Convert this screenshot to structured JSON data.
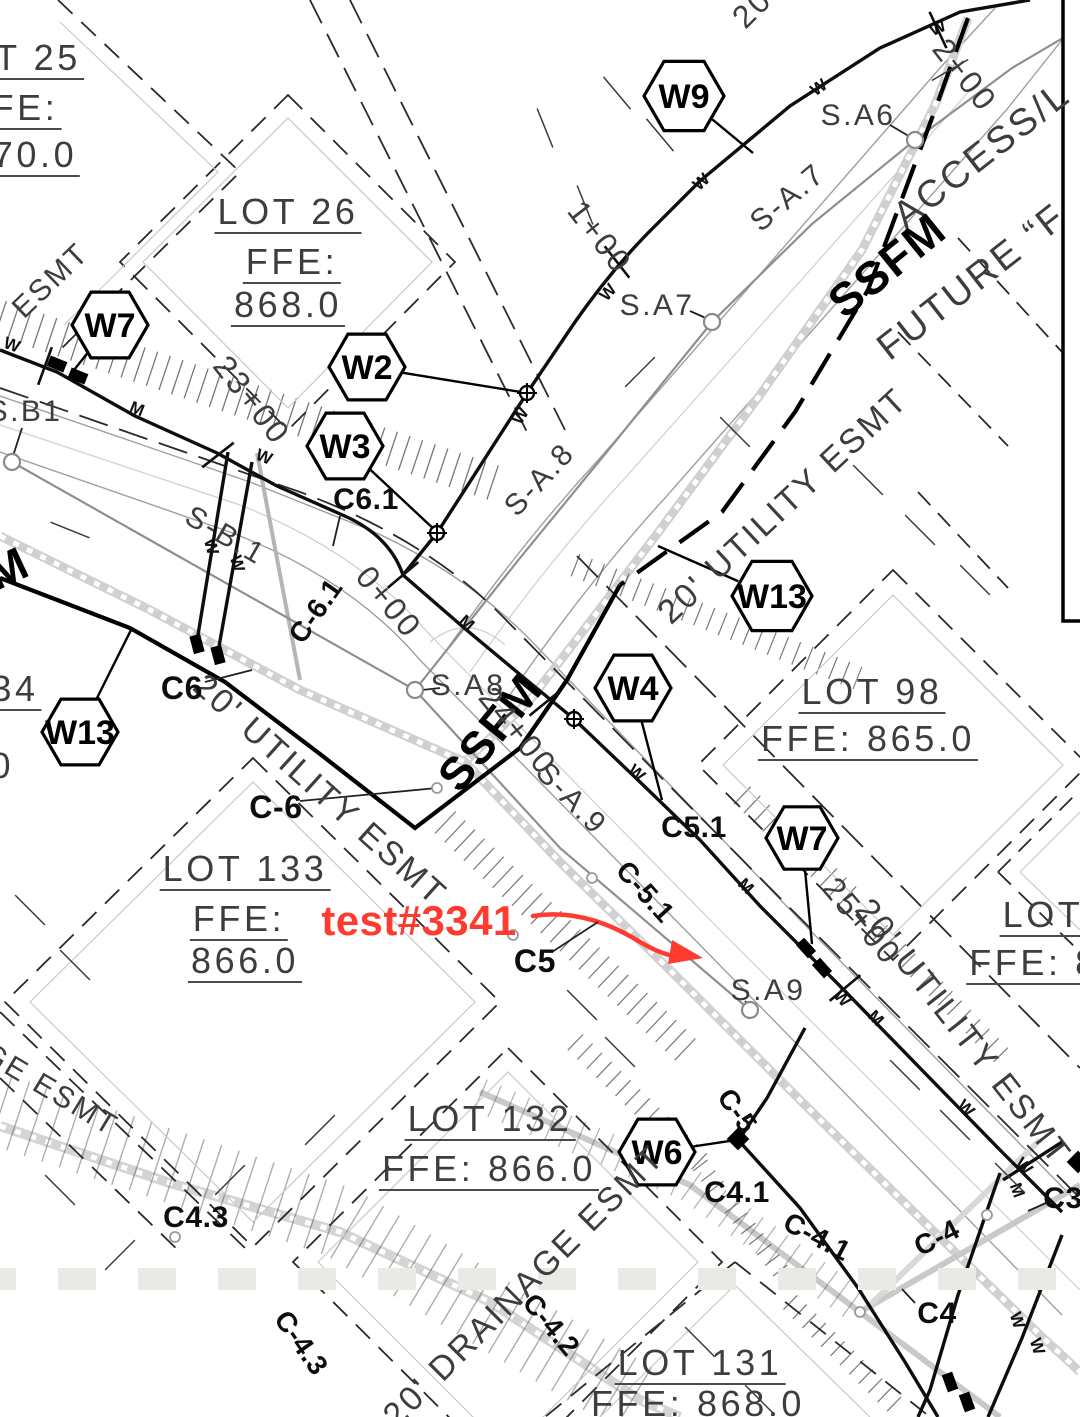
{
  "annotation": {
    "text": "test#3341",
    "color": "#ff3b30"
  },
  "colors": {
    "line_black": "#111111",
    "cad_text": "#3d3d3d",
    "road_gray": "#9f9f9f",
    "band_gray": "#d0d0d0",
    "grass_square": "#e7eae5",
    "annotation_red": "#ff3b30"
  },
  "label_groups": {
    "lots": [
      {
        "name": "lot25-number",
        "text": "T 25",
        "x": 38,
        "y": 60,
        "rot": 0,
        "fs": 36,
        "cls": "cadu"
      },
      {
        "name": "lot25-ffe",
        "text": "FE:",
        "x": 25,
        "y": 110,
        "rot": 0,
        "fs": 36,
        "cls": "cadu"
      },
      {
        "name": "lot25-ffe-value",
        "text": "70.0",
        "x": 35,
        "y": 157,
        "rot": 0,
        "fs": 36,
        "cls": "cadu"
      },
      {
        "name": "lot26-number",
        "text": "LOT 26",
        "x": 288,
        "y": 214,
        "rot": 0,
        "fs": 36,
        "cls": "cadu"
      },
      {
        "name": "lot26-ffe",
        "text": "FFE:",
        "x": 292,
        "y": 264,
        "rot": 0,
        "fs": 36,
        "cls": "cadu"
      },
      {
        "name": "lot26-ffe-value",
        "text": "868.0",
        "x": 288,
        "y": 307,
        "rot": 0,
        "fs": 36,
        "cls": "cadu"
      },
      {
        "name": "lot98-number",
        "text": "LOT 98",
        "x": 872,
        "y": 694,
        "rot": 0,
        "fs": 36,
        "cls": "cadu"
      },
      {
        "name": "lot98-ffe",
        "text": "FFE: 865.0",
        "x": 868,
        "y": 741,
        "rot": 0,
        "fs": 36,
        "cls": "cadu"
      },
      {
        "name": "lot133-number",
        "text": "LOT 133",
        "x": 245,
        "y": 871,
        "rot": 0,
        "fs": 36,
        "cls": "cadu"
      },
      {
        "name": "lot133-ffe",
        "text": "FFE:",
        "x": 239,
        "y": 921,
        "rot": 0,
        "fs": 36,
        "cls": "cadu"
      },
      {
        "name": "lot133-ffe-value",
        "text": "866.0",
        "x": 245,
        "y": 963,
        "rot": 0,
        "fs": 36,
        "cls": "cadu"
      },
      {
        "name": "lot132-number",
        "text": "LOT 132",
        "x": 490,
        "y": 1121,
        "rot": 0,
        "fs": 36,
        "cls": "cadu"
      },
      {
        "name": "lot132-ffe",
        "text": "FFE: 866.0",
        "x": 489,
        "y": 1171,
        "rot": 0,
        "fs": 36,
        "cls": "cadu"
      },
      {
        "name": "lot131-number",
        "text": "LOT 131",
        "x": 700,
        "y": 1365,
        "rot": 0,
        "fs": 36,
        "cls": "cadu"
      },
      {
        "name": "lot131-ffe",
        "text": "FFE: 868.0",
        "x": 698,
        "y": 1406,
        "rot": 0,
        "fs": 36,
        "cls": "cadu"
      },
      {
        "name": "lot-right-number",
        "text": "LOT",
        "x": 1043,
        "y": 917,
        "rot": 0,
        "fs": 36,
        "cls": "cadu"
      },
      {
        "name": "lot-right-ffe",
        "text": "FFE: 8",
        "x": 1034,
        "y": 965,
        "rot": 0,
        "fs": 36,
        "cls": "cadu"
      }
    ],
    "easements": [
      {
        "name": "esmt-top-left",
        "text": "ESMT",
        "x": 51,
        "y": 281,
        "rot": -44,
        "fs": 30,
        "cls": "cad"
      },
      {
        "name": "utility-esmt-top-right",
        "text": "20' UTILITY ESMT",
        "x": 783,
        "y": 506,
        "rot": -43,
        "fs": 34,
        "cls": "cad"
      },
      {
        "name": "utility-esmt-left",
        "text": "20' UTILITY ESMT",
        "x": 320,
        "y": 790,
        "rot": 42,
        "fs": 34,
        "cls": "cad"
      },
      {
        "name": "utility-esmt-right",
        "text": "20' UTILITY ESMT",
        "x": 963,
        "y": 1032,
        "rot": 52,
        "fs": 34,
        "cls": "cad"
      },
      {
        "name": "drainage-esmt",
        "text": "20' DRAINAGE ESMT",
        "x": 524,
        "y": 1286,
        "rot": -45,
        "fs": 34,
        "cls": "cad"
      },
      {
        "name": "drainage-esmt-frag",
        "text": "GE ESMT",
        "x": 50,
        "y": 1090,
        "rot": 31,
        "fs": 30,
        "cls": "cad"
      },
      {
        "name": "esmt-top-frag",
        "text": "20",
        "x": 752,
        "y": 8,
        "rot": -45,
        "fs": 32,
        "cls": "cad"
      },
      {
        "name": "access-road",
        "text": "ACCESS/L",
        "x": 982,
        "y": 155,
        "rot": -38,
        "fs": 38,
        "cls": "cad"
      },
      {
        "name": "future-road",
        "text": "FUTURE “F",
        "x": 972,
        "y": 282,
        "rot": -38,
        "fs": 38,
        "cls": "cad"
      }
    ],
    "force_main": [
      {
        "name": "ssfm-top",
        "text": "SSFM",
        "x": 887,
        "y": 265,
        "rot": -39,
        "fs": 46,
        "cls": "ssfm"
      },
      {
        "name": "ssfm-center",
        "text": "SSFM",
        "x": 490,
        "y": 732,
        "rot": -51,
        "fs": 46,
        "cls": "ssfm"
      },
      {
        "name": "ssfm-left",
        "text": "SSFM",
        "x": -35,
        "y": 588,
        "rot": -25,
        "fs": 46,
        "cls": "ssfm"
      }
    ],
    "sewer": [
      {
        "name": "manhole-sa6",
        "text": "S.A6",
        "x": 858,
        "y": 116,
        "rot": 0,
        "fs": 30,
        "cls": "cad"
      },
      {
        "name": "manhole-sa7",
        "text": "S.A7",
        "x": 657,
        "y": 306,
        "rot": 0,
        "fs": 30,
        "cls": "cad"
      },
      {
        "name": "manhole-sa8",
        "text": "S.A8",
        "x": 468,
        "y": 686,
        "rot": 0,
        "fs": 30,
        "cls": "cad"
      },
      {
        "name": "manhole-sa9",
        "text": "S.A9",
        "x": 768,
        "y": 991,
        "rot": 0,
        "fs": 30,
        "cls": "cad"
      },
      {
        "name": "manhole-sb1",
        "text": "S.B1",
        "x": 25,
        "y": 412,
        "rot": 0,
        "fs": 30,
        "cls": "cad"
      },
      {
        "name": "sewer-run-sa7",
        "text": "S-A.7",
        "x": 788,
        "y": 198,
        "rot": -40,
        "fs": 30,
        "cls": "cad"
      },
      {
        "name": "sewer-run-sa8",
        "text": "S-A.8",
        "x": 540,
        "y": 480,
        "rot": -47,
        "fs": 30,
        "cls": "cad"
      },
      {
        "name": "sewer-run-sa9",
        "text": "S-A.9",
        "x": 571,
        "y": 799,
        "rot": 46,
        "fs": 30,
        "cls": "cad"
      },
      {
        "name": "sewer-run-sb1",
        "text": "S-B.1",
        "x": 225,
        "y": 536,
        "rot": 30,
        "fs": 30,
        "cls": "cad"
      }
    ],
    "stations": [
      {
        "name": "station-2-00",
        "text": "2+00",
        "x": 965,
        "y": 75,
        "rot": 52,
        "fs": 32,
        "cls": "cad"
      },
      {
        "name": "station-1-00",
        "text": "1+00",
        "x": 600,
        "y": 237,
        "rot": 52,
        "fs": 32,
        "cls": "cad"
      },
      {
        "name": "station-0-00",
        "text": "0+00",
        "x": 389,
        "y": 602,
        "rot": 50,
        "fs": 32,
        "cls": "cad"
      },
      {
        "name": "station-23-00",
        "text": "23+00",
        "x": 252,
        "y": 400,
        "rot": 52,
        "fs": 32,
        "cls": "cad"
      },
      {
        "name": "station-24-00",
        "text": "24+00",
        "x": 518,
        "y": 731,
        "rot": 51,
        "fs": 32,
        "cls": "cad"
      },
      {
        "name": "station-25-00",
        "text": "25+00",
        "x": 862,
        "y": 921,
        "rot": 50,
        "fs": 32,
        "cls": "cad"
      }
    ],
    "curve_callouts": [
      {
        "name": "callout-c6-1",
        "text": "C6.1",
        "x": 366,
        "y": 500,
        "rot": 0,
        "fs": 30,
        "cls": "c"
      },
      {
        "name": "callout-c-6-1",
        "text": "C-6.1",
        "x": 316,
        "y": 611,
        "rot": -55,
        "fs": 28,
        "cls": "c"
      },
      {
        "name": "callout-c6",
        "text": "C6",
        "x": 182,
        "y": 688,
        "rot": 0,
        "fs": 32,
        "cls": "c"
      },
      {
        "name": "callout-c-6",
        "text": "C-6",
        "x": 276,
        "y": 807,
        "rot": 0,
        "fs": 32,
        "cls": "c"
      },
      {
        "name": "callout-c5-1",
        "text": "C5.1",
        "x": 694,
        "y": 828,
        "rot": 0,
        "fs": 30,
        "cls": "c"
      },
      {
        "name": "callout-c-5-1",
        "text": "C-5.1",
        "x": 645,
        "y": 892,
        "rot": 48,
        "fs": 28,
        "cls": "c"
      },
      {
        "name": "callout-c5",
        "text": "C5",
        "x": 535,
        "y": 961,
        "rot": 0,
        "fs": 32,
        "cls": "c"
      },
      {
        "name": "callout-c-5",
        "text": "C-5",
        "x": 737,
        "y": 1111,
        "rot": 55,
        "fs": 28,
        "cls": "c"
      },
      {
        "name": "callout-c4-1",
        "text": "C4.1",
        "x": 737,
        "y": 1193,
        "rot": 0,
        "fs": 30,
        "cls": "c"
      },
      {
        "name": "callout-c-4-1",
        "text": "C-4.1",
        "x": 817,
        "y": 1237,
        "rot": 28,
        "fs": 28,
        "cls": "c"
      },
      {
        "name": "callout-c4",
        "text": "C4",
        "x": 937,
        "y": 1314,
        "rot": 0,
        "fs": 30,
        "cls": "c"
      },
      {
        "name": "callout-c-4",
        "text": "C-4",
        "x": 937,
        "y": 1238,
        "rot": -27,
        "fs": 28,
        "cls": "c"
      },
      {
        "name": "callout-c4-3",
        "text": "C4.3",
        "x": 196,
        "y": 1218,
        "rot": 0,
        "fs": 30,
        "cls": "c"
      },
      {
        "name": "callout-c-4-3",
        "text": "C-4.3",
        "x": 301,
        "y": 1343,
        "rot": 55,
        "fs": 28,
        "cls": "c"
      },
      {
        "name": "callout-c-4-2",
        "text": "C-4.2",
        "x": 551,
        "y": 1325,
        "rot": 50,
        "fs": 28,
        "cls": "c"
      },
      {
        "name": "callout-c3",
        "text": "C3",
        "x": 1063,
        "y": 1199,
        "rot": 0,
        "fs": 30,
        "cls": "c"
      }
    ],
    "fragments": [
      {
        "name": "fragment-34",
        "text": "34",
        "x": 15,
        "y": 691,
        "rot": 0,
        "fs": 36,
        "cls": "cadu"
      },
      {
        "name": "fragment-0",
        "text": "0",
        "x": 2,
        "y": 766,
        "rot": 0,
        "fs": 36,
        "cls": "cad"
      }
    ]
  },
  "hex_flags": [
    {
      "name": "flag-w9",
      "label": "W9",
      "cx": 684,
      "cy": 96,
      "r": 40,
      "lx": 753,
      "ly": 153
    },
    {
      "name": "flag-w7-left",
      "label": "W7",
      "cx": 110,
      "cy": 325,
      "r": 38,
      "lx": 74,
      "ly": 370
    },
    {
      "name": "flag-w2",
      "label": "W2",
      "cx": 367,
      "cy": 367,
      "r": 38,
      "lx": 527,
      "ly": 393
    },
    {
      "name": "flag-w3",
      "label": "W3",
      "cx": 345,
      "cy": 446,
      "r": 38,
      "lx": 437,
      "ly": 532
    },
    {
      "name": "flag-w13-right",
      "label": "W13",
      "cx": 772,
      "cy": 596,
      "r": 40,
      "lx": 658,
      "ly": 546
    },
    {
      "name": "flag-w4",
      "label": "W4",
      "cx": 633,
      "cy": 688,
      "r": 38,
      "lx": 662,
      "ly": 800
    },
    {
      "name": "flag-w13-left",
      "label": "W13",
      "cx": 80,
      "cy": 732,
      "r": 38,
      "lx": 131,
      "ly": 630
    },
    {
      "name": "flag-w7-right",
      "label": "W7",
      "cx": 802,
      "cy": 838,
      "r": 36,
      "lx": 812,
      "ly": 944
    },
    {
      "name": "flag-w6",
      "label": "W6",
      "cx": 657,
      "cy": 1152,
      "r": 38,
      "lx": 736,
      "ly": 1140
    }
  ],
  "pipe_markers": [
    {
      "ch": "W",
      "x": 10,
      "y": 350,
      "rot": 20
    },
    {
      "ch": "M",
      "x": 135,
      "y": 414,
      "rot": 22
    },
    {
      "ch": "W",
      "x": 262,
      "y": 462,
      "rot": 22
    },
    {
      "ch": "W",
      "x": 206,
      "y": 548,
      "rot": 75
    },
    {
      "ch": "W",
      "x": 232,
      "y": 565,
      "rot": 75
    },
    {
      "ch": "W",
      "x": 525,
      "y": 419,
      "rot": -57
    },
    {
      "ch": "W",
      "x": 612,
      "y": 296,
      "rot": -48
    },
    {
      "ch": "W",
      "x": 705,
      "y": 186,
      "rot": -42
    },
    {
      "ch": "W",
      "x": 822,
      "y": 92,
      "rot": -35
    },
    {
      "ch": "W",
      "x": 940,
      "y": 33,
      "rot": -25
    },
    {
      "ch": "M",
      "x": 463,
      "y": 627,
      "rot": 42
    },
    {
      "ch": "W",
      "x": 633,
      "y": 777,
      "rot": 42
    },
    {
      "ch": "M",
      "x": 742,
      "y": 890,
      "rot": 45
    },
    {
      "ch": "W",
      "x": 838,
      "y": 1002,
      "rot": 48
    },
    {
      "ch": "M",
      "x": 872,
      "y": 1022,
      "rot": 45
    },
    {
      "ch": "W",
      "x": 962,
      "y": 1112,
      "rot": 45
    },
    {
      "ch": "W",
      "x": 1020,
      "y": 1170,
      "rot": 45
    },
    {
      "ch": "M",
      "x": 1012,
      "y": 1192,
      "rot": 70
    },
    {
      "ch": "W",
      "x": 1012,
      "y": 1322,
      "rot": 72
    },
    {
      "ch": "W",
      "x": 1032,
      "y": 1348,
      "rot": 72
    }
  ],
  "leader_lines": [
    [
      890,
      125,
      912,
      138
    ],
    [
      690,
      311,
      708,
      319
    ],
    [
      22,
      428,
      13,
      456
    ],
    [
      440,
      688,
      422,
      690
    ],
    [
      300,
      801,
      437,
      788
    ],
    [
      205,
      682,
      252,
      670
    ],
    [
      552,
      952,
      598,
      922
    ],
    [
      745,
      1001,
      751,
      1007
    ],
    [
      340,
      516,
      333,
      546
    ],
    [
      915,
      1303,
      902,
      1289
    ],
    [
      1046,
      1203,
      1028,
      1211
    ]
  ],
  "fittings": [
    [
      437,
      533
    ],
    [
      527,
      393
    ],
    [
      574,
      719
    ]
  ],
  "valves_rect": [
    [
      57,
      364,
      22
    ],
    [
      78,
      376,
      22
    ],
    [
      806,
      948,
      48
    ],
    [
      822,
      968,
      48
    ],
    [
      197,
      644,
      75
    ],
    [
      218,
      655,
      75
    ],
    [
      950,
      1382,
      70
    ],
    [
      967,
      1402,
      70
    ]
  ],
  "valves_diamond": [
    [
      738,
      1139
    ],
    [
      1078,
      1162
    ]
  ],
  "manholes": [
    [
      12,
      462
    ],
    [
      415,
      690
    ],
    [
      750,
      1010
    ],
    [
      712,
      322
    ],
    [
      915,
      140
    ]
  ],
  "cleanouts": [
    [
      437,
      788
    ],
    [
      513,
      935
    ],
    [
      592,
      878
    ],
    [
      860,
      1312
    ],
    [
      987,
      1215
    ],
    [
      175,
      1237
    ]
  ],
  "station_ticks": [
    [
      45,
      366,
      20
    ],
    [
      218,
      455,
      52
    ],
    [
      403,
      575,
      50
    ],
    [
      545,
      703,
      51
    ],
    [
      845,
      988,
      50
    ],
    [
      617,
      262,
      -38
    ],
    [
      938,
      30,
      -25
    ]
  ],
  "grass_row": {
    "y": 1268,
    "x_start": -22,
    "step": 80,
    "count": 15,
    "w": 38,
    "h": 22
  },
  "decor_dashes": [
    [
      617,
      93,
      50
    ],
    [
      660,
      135,
      50
    ],
    [
      868,
      480,
      45
    ],
    [
      920,
      530,
      45
    ],
    [
      975,
      580,
      45
    ],
    [
      735,
      432,
      45
    ],
    [
      640,
      372,
      -45
    ],
    [
      582,
      1005,
      45
    ],
    [
      620,
      1052,
      45
    ],
    [
      905,
      1075,
      45
    ],
    [
      955,
      1125,
      45
    ],
    [
      1010,
      1178,
      45
    ],
    [
      60,
      1190,
      45
    ],
    [
      120,
      1255,
      -45
    ],
    [
      230,
      1180,
      -45
    ],
    [
      320,
      1130,
      -45
    ],
    [
      30,
      910,
      45
    ],
    [
      75,
      965,
      45
    ],
    [
      585,
      205,
      68
    ],
    [
      545,
      128,
      68
    ],
    [
      700,
      1342,
      45
    ],
    [
      760,
      1400,
      45
    ],
    [
      70,
      530,
      22
    ],
    [
      950,
      70,
      -30
    ]
  ]
}
